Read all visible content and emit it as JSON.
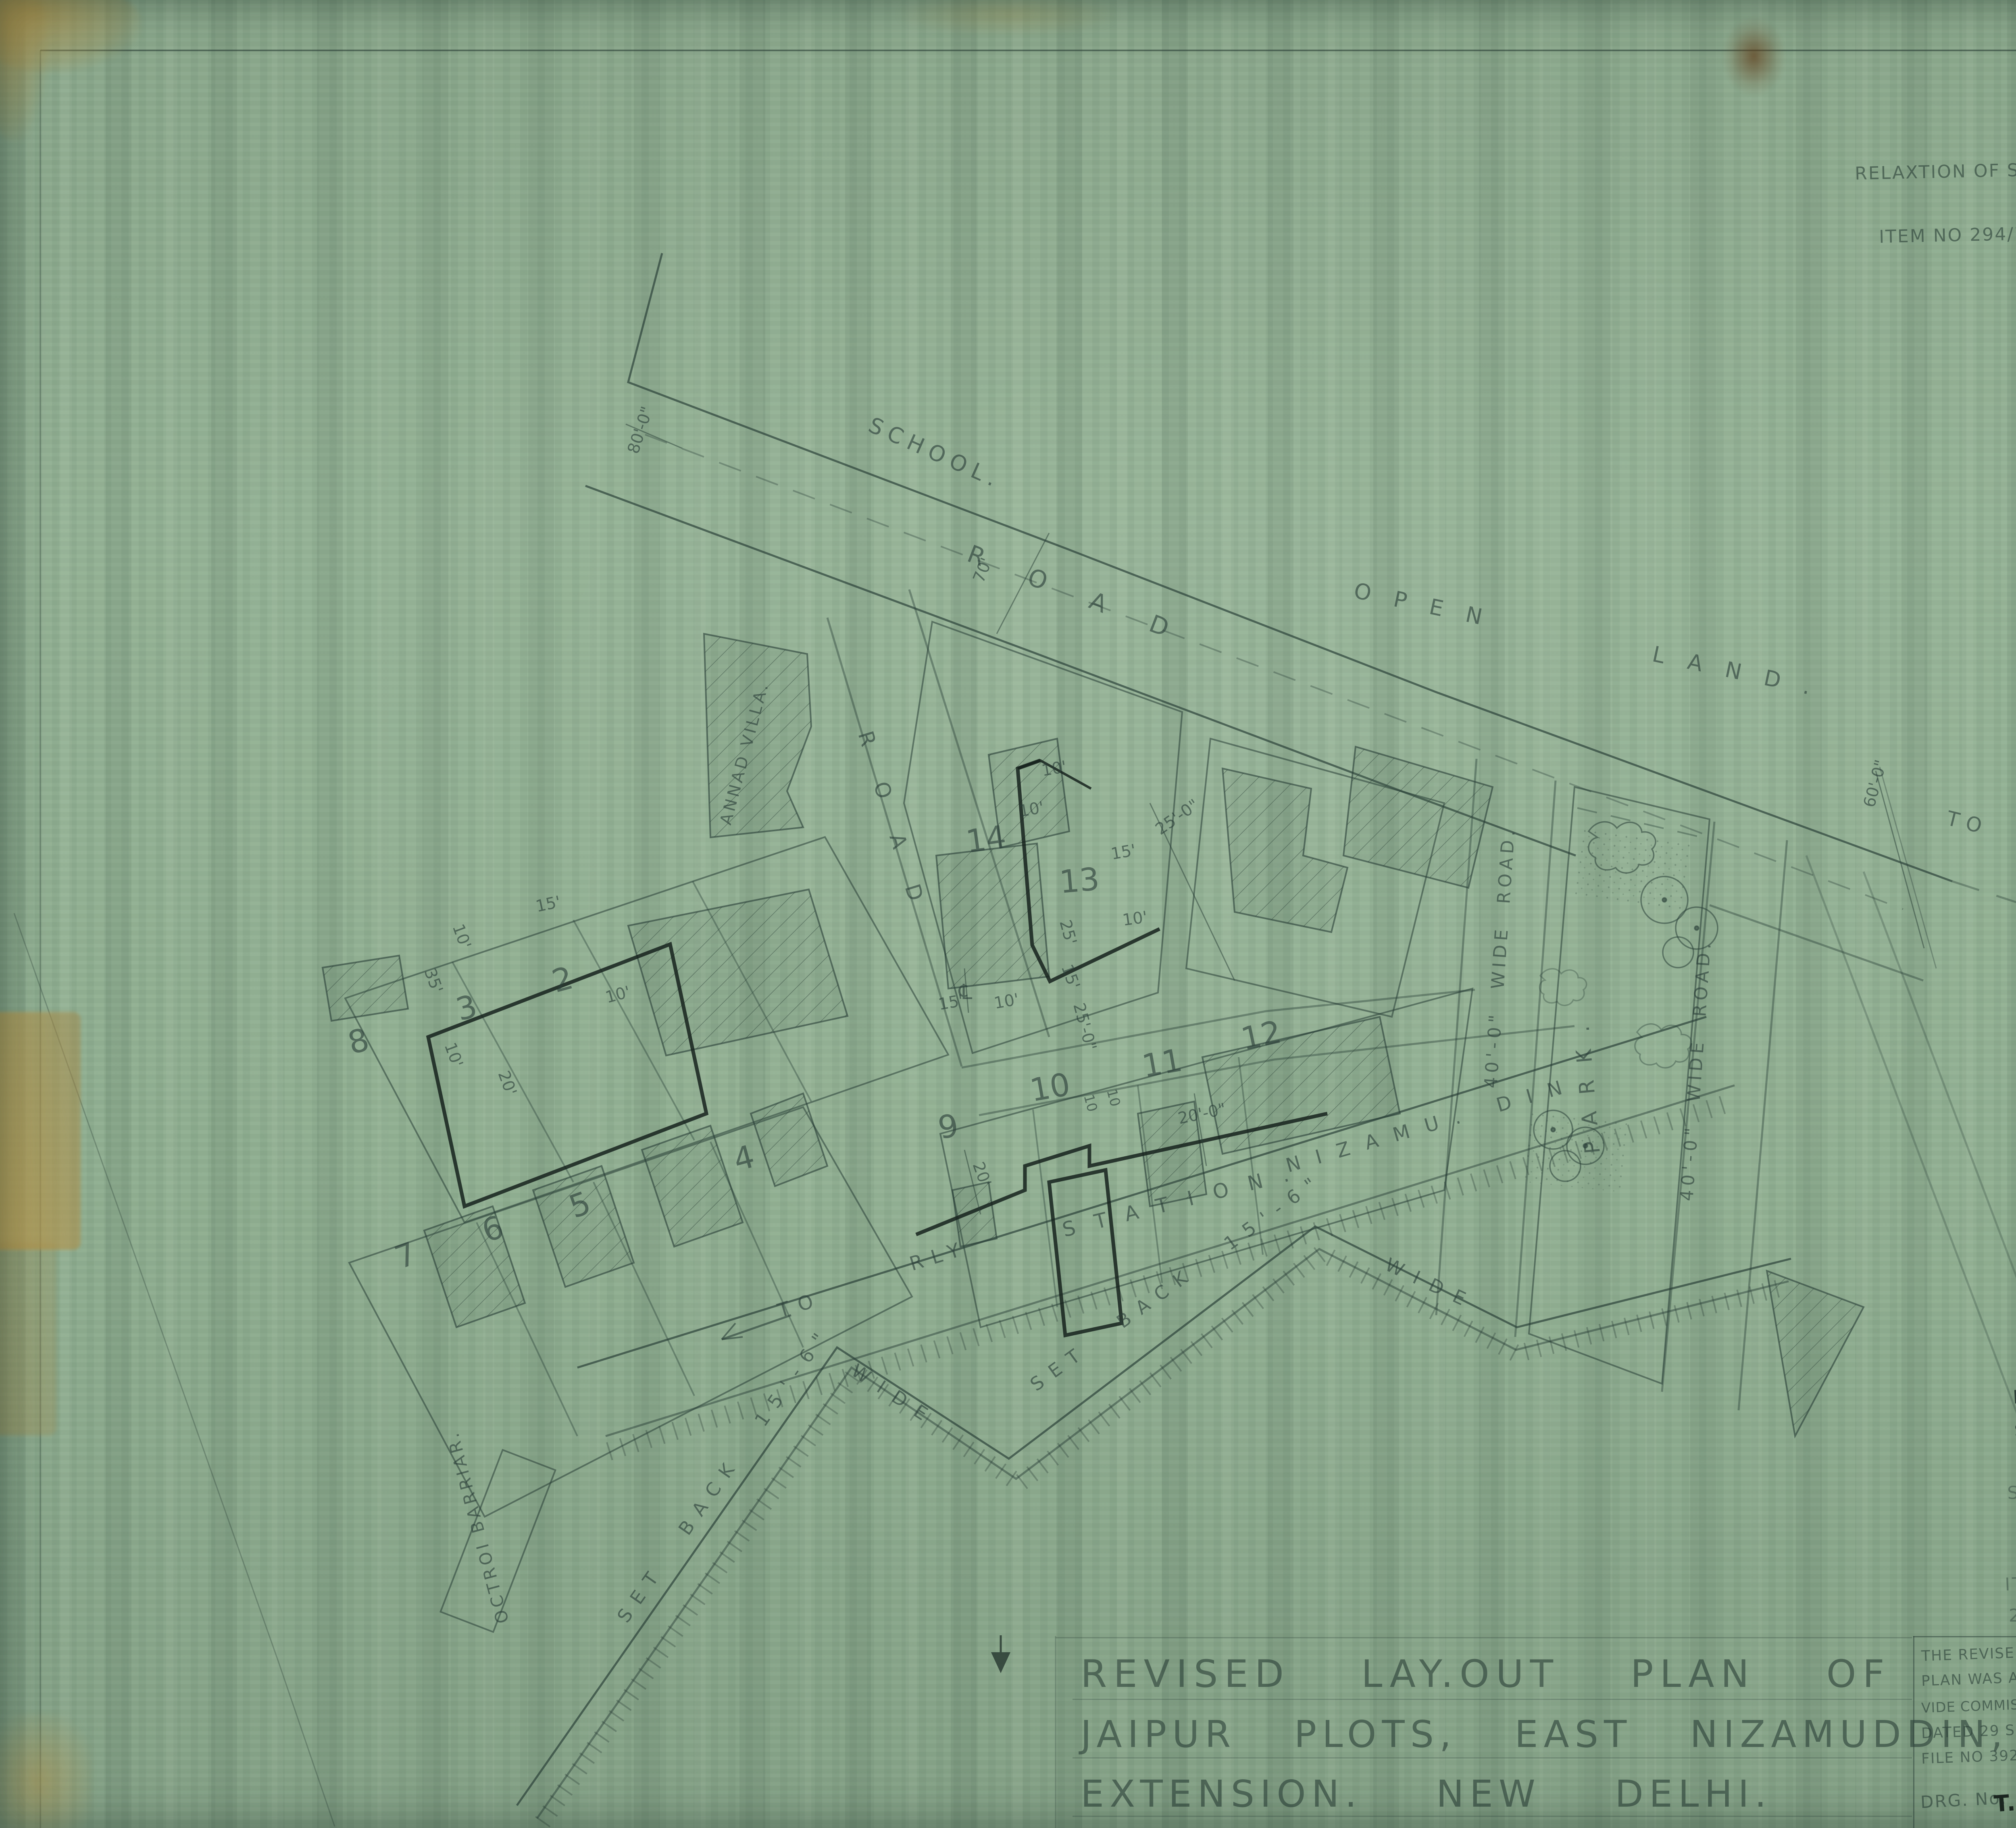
{
  "corner_mark": "RS.199",
  "top_note": {
    "line1": "RELAXTION OF SET BACK FROM 15'-0\" TO 10'-0\" APPROVED BY S.D.C. VIDE",
    "line2": "ITEM NO 294/72 DATED 24.6.72 FOR PLOT NO 3 JAIPUR",
    "signoff_title": "Jt. TOWN PLANNER"
  },
  "references": {
    "heading": "REFERANCES.",
    "line1": "THE SET BACK LINES ARE APPROVED VIDE",
    "line2": "ITEM NO.9. L.O.C. DATED 3.5.1963.",
    "item1": "1.FRONT SET BACK  =  20FT.",
    "item2": "2-REAR    \"        \"    =  10 \"  (15' IN THE CASE OF BACK TO",
    "item2_cont": "BACK PLOTS )",
    "item3": "3- SIDE    \"        \"    =  10 \""
  },
  "approval_sign": {
    "drafter_name": "L. N. SHARMA.",
    "drafter_title": "Sr. D/Man.",
    "date": "6/6/63",
    "checked_by": "CHECKED BY.",
    "checker": "R. P. KOHLI.",
    "checker_title": "A.A.(B)"
  },
  "plot13_note": {
    "line1": "SET BACK OF PLOT Nº 13 ARE APPROVED",
    "line2": "BY.  D.C(E)  ON 3.12.64   AS  PER",
    "line3": "ITEM Nº 461/64. VIDE RESOLUTION Nº 258 DATED",
    "line4": "25.5.64",
    "traced_sig": "R.Khanna.",
    "traced_by": "TRACED BY",
    "arch_date": "23.12.64",
    "arch_title": "ASST. ARCHITECT"
  },
  "title": {
    "line1": "REVISED LAY.OUT PLAN OF",
    "line2": "JAIPUR PLOTS, EAST NIZAMUDDIN,",
    "line3": "EXTENSION. NEW DELHI."
  },
  "title_block": {
    "approval_lines": [
      "THE REVISED LAY-OUT",
      "PLAN WAS APPROVED",
      "VIDE COMMISSIONER ORDER",
      "DATED 29 SEP. 1962.",
      "FILE NO 392. T.P. M.C.D."
    ],
    "drg_label": "DRG. No.",
    "drg_no": "T.P./RS/199",
    "drawn_by": "DRAWN BY, L.N. SHARMA",
    "drawn_by_title": "SR D/MAN.",
    "scale_label": "SCALE :-",
    "scale_value": "50 FEET TO AN INCH.",
    "architect": "R. L. BAWA.",
    "architect_qual": "N.D. ARCH. DIP. T.P. (LONDON)",
    "architect_org": "M. C. DELHI."
  },
  "plan": {
    "school": "SCHOOL.",
    "road": "ROAD",
    "open_land": "OPEN LAND.",
    "to_mathura": "TO MATHURA ROAD.",
    "annad_villa": "ANNAD VILLA.",
    "park": "PARK.",
    "wide_road": "40'-0\" WIDE ROAD.",
    "to": "TO",
    "rly": "RLY",
    "station": "STATION.",
    "nizamuddin": "NIZAMU. DIN",
    "set_back": "SET BACK 15'-6\"",
    "wide": "WIDE",
    "octroi": "OCTROI BARRIAR.",
    "centerline": "℄",
    "plots": {
      "p2": "2",
      "p3": "3",
      "p4": "4",
      "p5": "5",
      "p6": "6",
      "p7": "7",
      "p8": "8",
      "p9": "9",
      "p10": "10",
      "p11": "11",
      "p12": "12",
      "p13": "13",
      "p14": "14"
    },
    "dims": {
      "d10": "10'",
      "d10p": "10",
      "d15": "15'",
      "d20": "20'",
      "d25": "25'",
      "d35": "35'",
      "d20_0": "20'-0\"",
      "d25_0": "25'-0\"",
      "d15_6": "15'-6\"",
      "d60_0": "60'-0\"",
      "d70": "70'",
      "d80_0": "80'-0\""
    }
  }
}
